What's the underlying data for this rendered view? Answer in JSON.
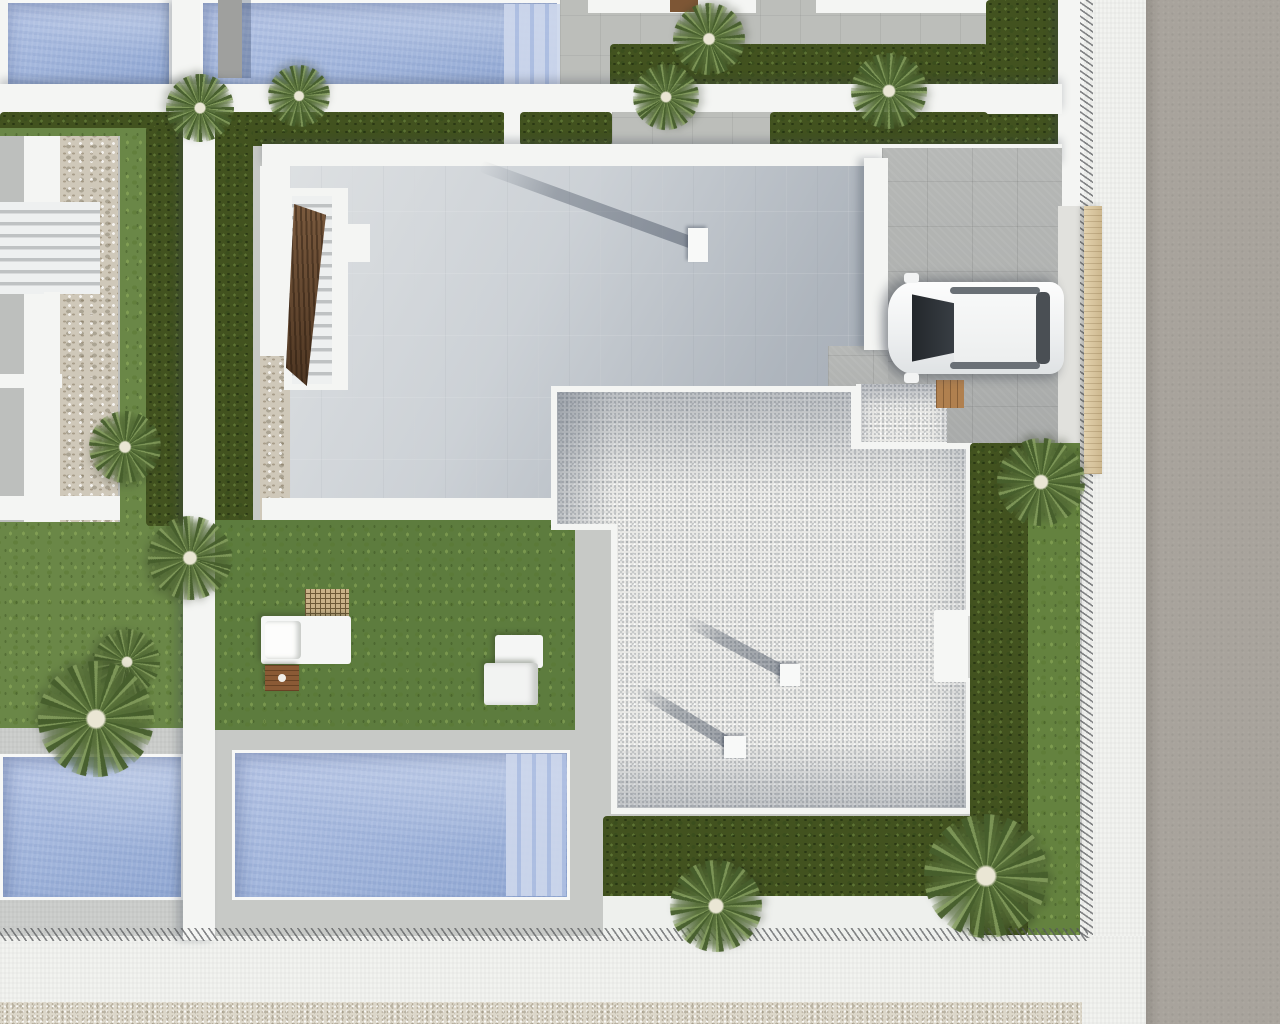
{
  "scene": {
    "title": "Aerial top-down 3D render of a modern villa development",
    "description": "Bird's-eye architectural visualization: central villa with smooth-tiled terrace and gravel flat roof, white SUV on driveway, rectangular pools top and bottom, lawns with hedges, palm trees, garden furniture, perimeter white sidewalk with fence line, gravel verge and asphalt road.",
    "light_direction": "sun from lower-right; shadows cast toward upper-left",
    "palette": {
      "water": "#a6b9de",
      "water_steps": "#cdd7ec",
      "lawn": "#64823f",
      "hedge": "#42521f",
      "terrace_tile": "#ccd1d6",
      "gravel_roof": "#e9e9e6",
      "driveway_tile": "#b0b2b0",
      "road": "#a8a39c",
      "sidewalk": "#f2f3f0",
      "wall_white": "#f4f5f3",
      "stone_wall": "#cfc8b9",
      "gate_wood": "#d8c49c",
      "furniture_wood": "#8a5a35",
      "car_body": "#f5f6f6",
      "car_glass": "#33383d",
      "gravel_verge": "#dcd7ca"
    },
    "objects": {
      "pools": [
        {
          "name": "upper-left pool",
          "x": 0,
          "y": 0,
          "w": 172,
          "h": 88
        },
        {
          "name": "upper pool with steps",
          "x": 200,
          "y": 0,
          "w": 360,
          "h": 96,
          "steps": "right"
        },
        {
          "name": "lower-left pool",
          "x": 0,
          "y": 754,
          "w": 184,
          "h": 146
        },
        {
          "name": "lower pool with steps",
          "x": 232,
          "y": 750,
          "w": 338,
          "h": 150,
          "steps": "right"
        }
      ],
      "car": {
        "x": 888,
        "y": 282,
        "length": 176,
        "width": 92,
        "color": "white SUV",
        "heading": "nose to the left (west)"
      },
      "palms": [
        {
          "cx": 200,
          "cy": 108,
          "r": 34
        },
        {
          "cx": 299,
          "cy": 96,
          "r": 31
        },
        {
          "cx": 709,
          "cy": 39,
          "r": 36
        },
        {
          "cx": 666,
          "cy": 97,
          "r": 33
        },
        {
          "cx": 889,
          "cy": 91,
          "r": 38
        },
        {
          "cx": 125,
          "cy": 447,
          "r": 36
        },
        {
          "cx": 190,
          "cy": 558,
          "r": 42
        },
        {
          "cx": 127,
          "cy": 662,
          "r": 33
        },
        {
          "cx": 96,
          "cy": 719,
          "r": 58
        },
        {
          "cx": 1041,
          "cy": 482,
          "r": 44
        },
        {
          "cx": 716,
          "cy": 906,
          "r": 46
        },
        {
          "cx": 986,
          "cy": 876,
          "r": 62
        }
      ],
      "chimneys": [
        {
          "cx": 698,
          "cy": 245,
          "w": 20,
          "h": 34,
          "shadow_len": 232,
          "shadow_angle": 20
        },
        {
          "cx": 790,
          "cy": 675,
          "w": 20,
          "h": 22,
          "shadow_len": 118,
          "shadow_angle": 28
        },
        {
          "cx": 735,
          "cy": 747,
          "w": 22,
          "h": 22,
          "shadow_len": 112,
          "shadow_angle": 31
        }
      ],
      "furniture": [
        {
          "name": "pergola lattice",
          "x": 305,
          "y": 589,
          "w": 44,
          "h": 30
        },
        {
          "name": "white daybed",
          "x": 261,
          "y": 616,
          "w": 90,
          "h": 48
        },
        {
          "name": "wooden side table",
          "x": 265,
          "y": 665,
          "w": 34,
          "h": 26
        },
        {
          "name": "white lounge chair set",
          "x": 484,
          "y": 635,
          "w": 65,
          "h": 70
        },
        {
          "name": "wooden door mat",
          "x": 936,
          "y": 380,
          "w": 28,
          "h": 28
        }
      ]
    }
  }
}
